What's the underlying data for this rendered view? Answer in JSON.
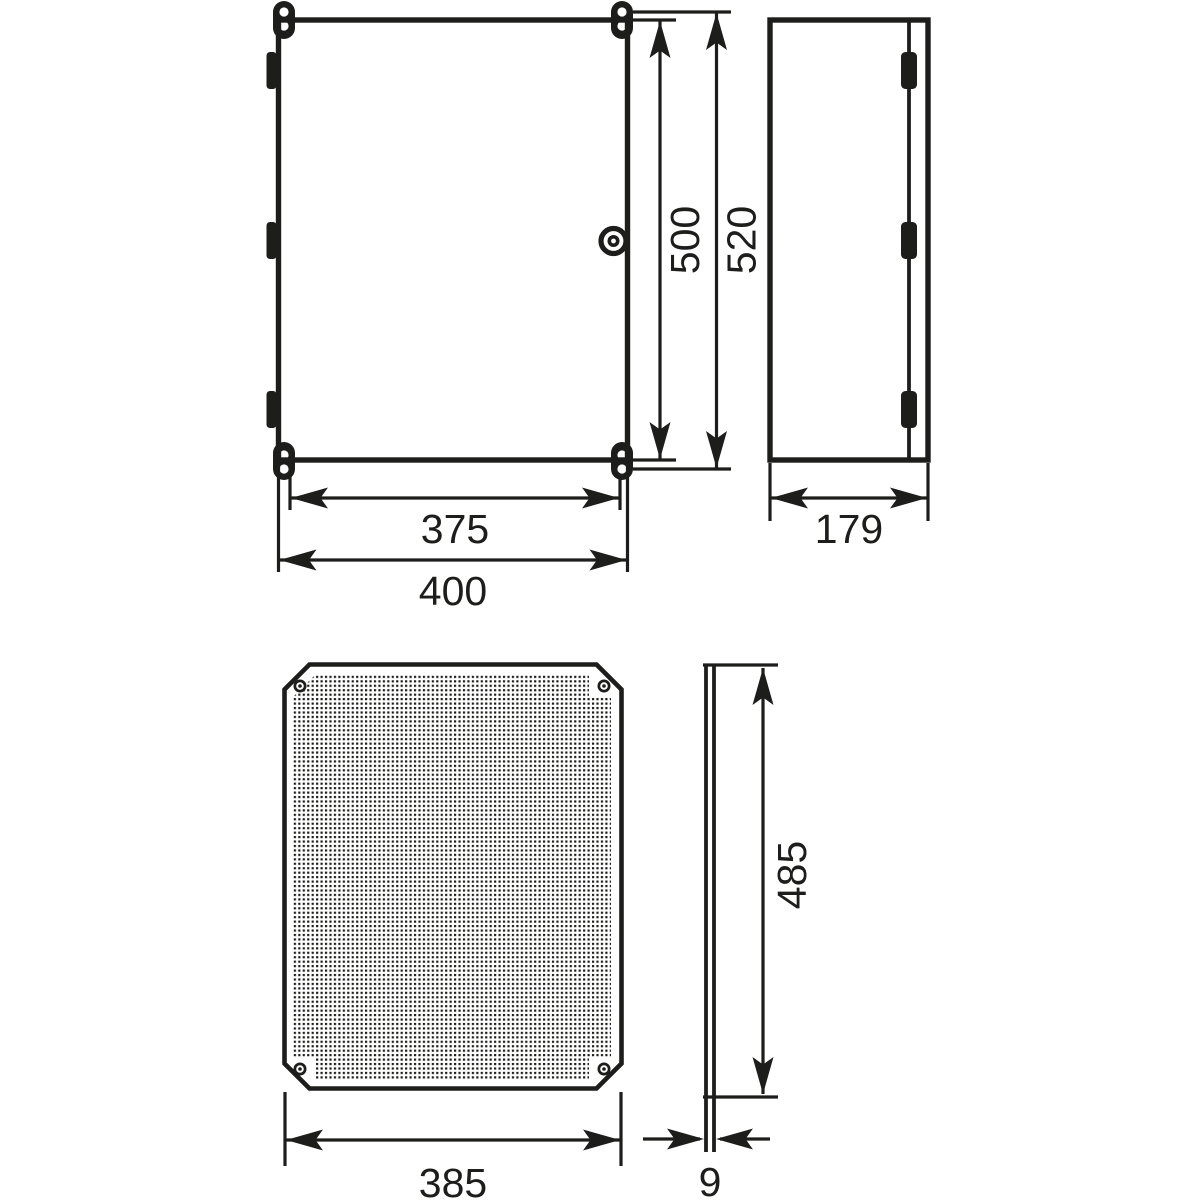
{
  "drawing": {
    "background_color": "#ffffff",
    "line_color": "#1d1d1b",
    "views": {
      "front": {
        "name": "enclosure-front-view"
      },
      "side": {
        "name": "enclosure-side-view"
      },
      "plate": {
        "name": "mounting-plate-front-view"
      },
      "plate_edge": {
        "name": "mounting-plate-edge-view"
      }
    },
    "dimension_labels": {
      "front_height_inner": "500",
      "front_height_outer": "520",
      "front_width_inner": "375",
      "front_width_outer": "400",
      "side_depth": "179",
      "plate_width": "385",
      "plate_height": "485",
      "plate_thickness": "9"
    }
  }
}
